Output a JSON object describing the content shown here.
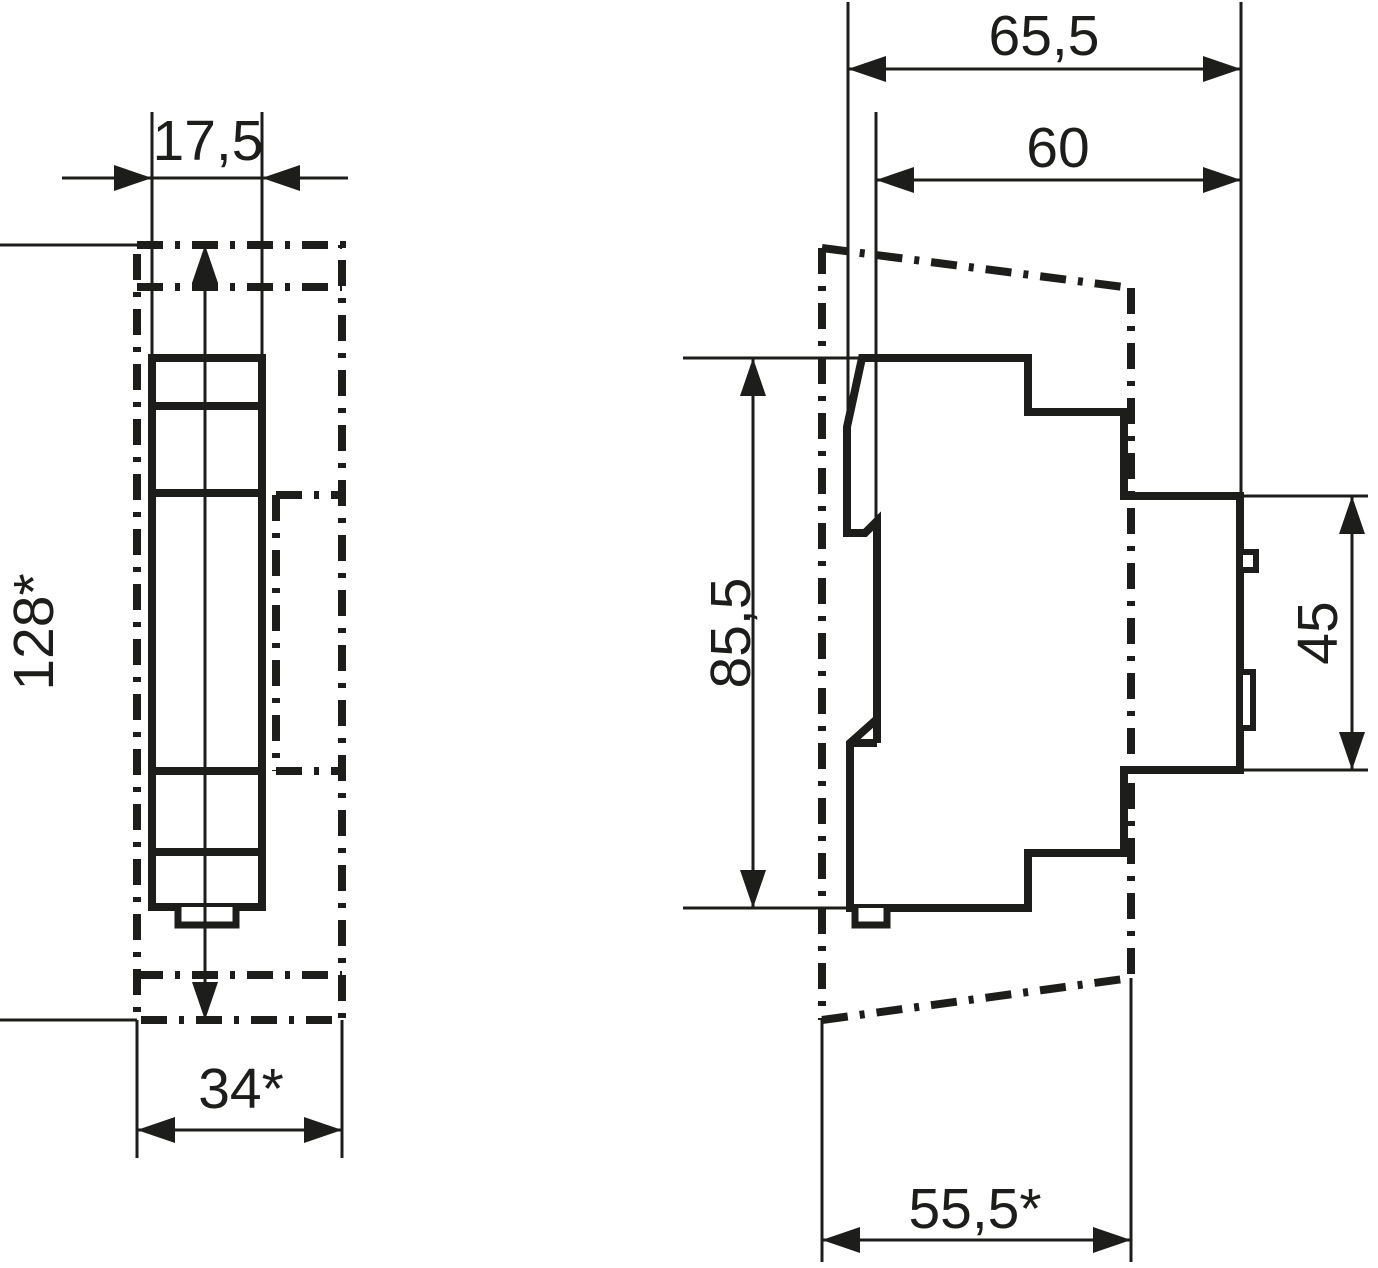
{
  "colors": {
    "line": "#1d1d1b",
    "background": "#ffffff"
  },
  "front_view": {
    "module_width": "17,5",
    "overall_height": "128*",
    "cutout_width": "34*"
  },
  "side_view": {
    "overall_depth": "65,5",
    "depth_behind_front": "60",
    "body_height": "85,5",
    "front_section_height": "45",
    "cutout_depth": "55,5*"
  }
}
